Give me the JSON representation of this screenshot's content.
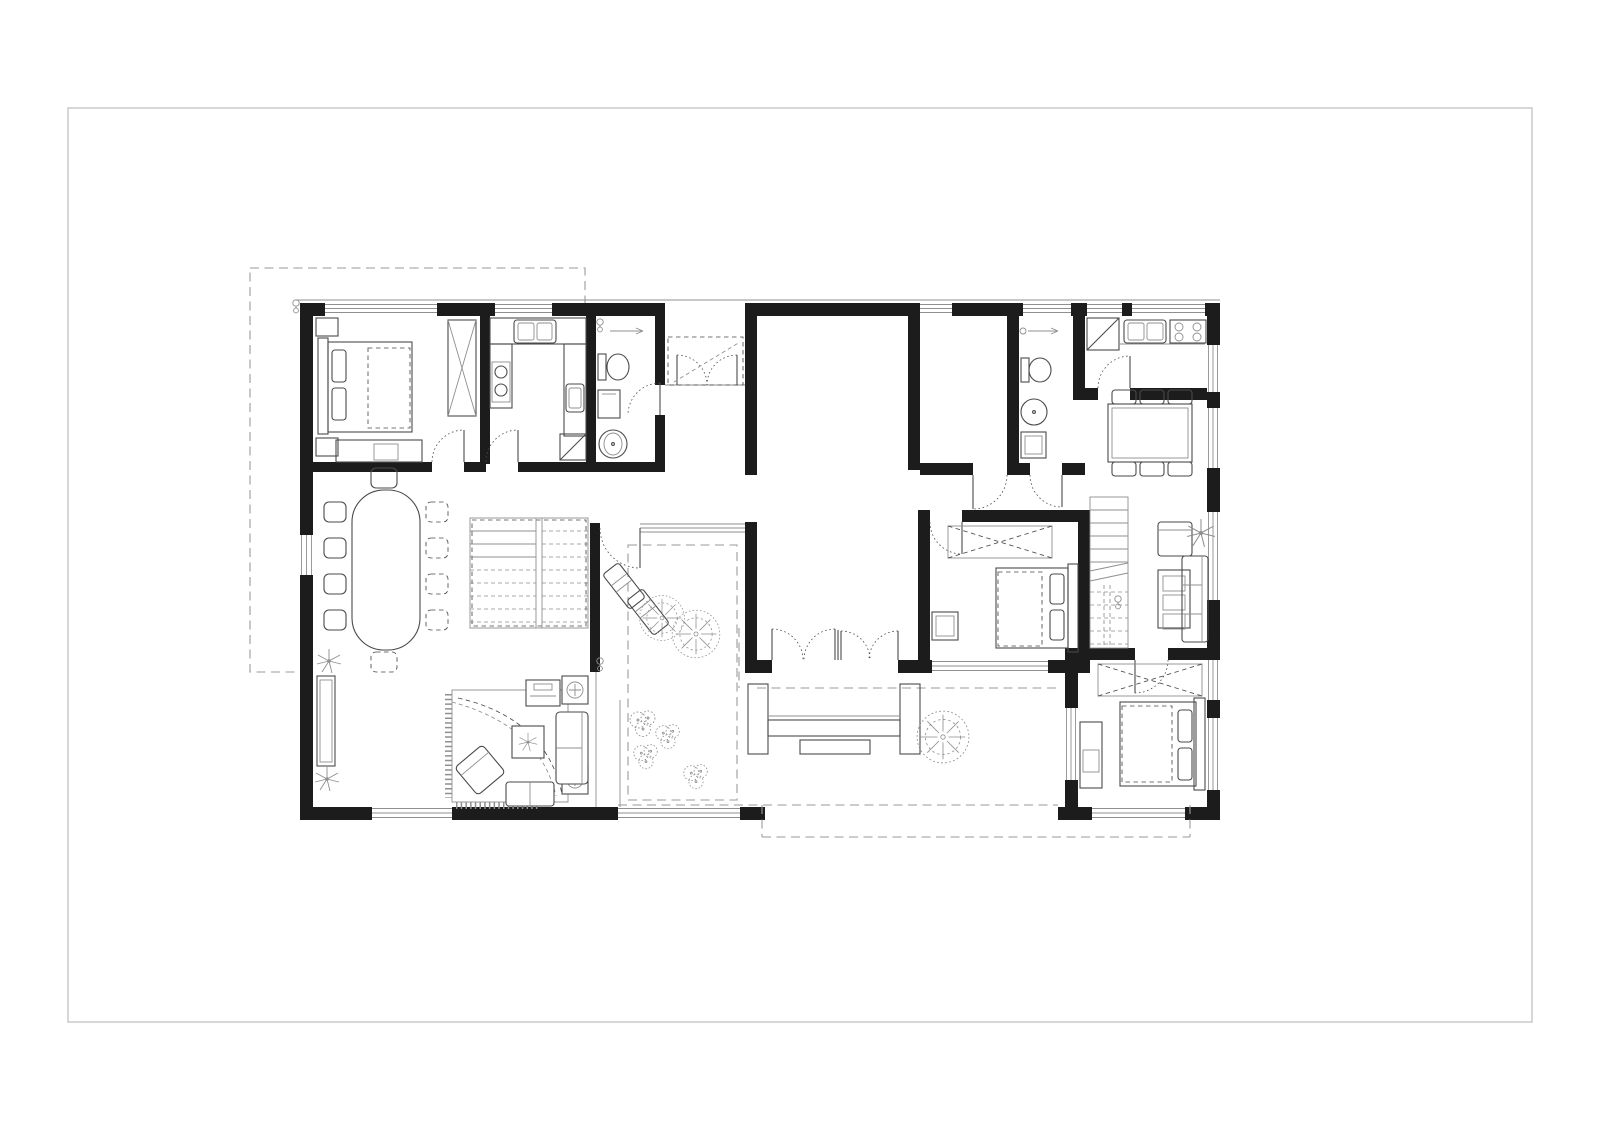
{
  "document": {
    "kind": "architectural floor plan sheet",
    "visible_text": [],
    "sheet": {
      "border": true
    }
  },
  "colors": {
    "paper": "#ffffff",
    "wall": "#1c1c1c",
    "line": "#4a4a4a",
    "lightline": "#8f8f8f",
    "dash": "#9a9a9a",
    "sheetBorder": "#c6c6c6"
  },
  "icons": {
    "tree-icon": "scribbled plan-view tree canopy",
    "shrub-icon": "cluster of small plan shrubs",
    "palm-plant-icon": "potted plant star symbol",
    "electrical-symbol-icon": "small wall-mounted fixture symbol",
    "door-swing-icon": "dotted quarter-circle door swing",
    "window-icon": "triple-line glazing in wall opening",
    "wardrobe-icon": "dashed crossed rectangle",
    "stair-icon": "stepped flight with break line"
  },
  "plan": {
    "outline": "rectangular villa with recessed north entry porch, inner courtyard and south terrace; dashed site/garage outline at upper left",
    "rooms": [
      {
        "id": "bedroom-1",
        "furniture": [
          "double-bed",
          "nightstands",
          "wardrobe",
          "desk"
        ]
      },
      {
        "id": "prep-kitchen",
        "furniture": [
          "double-sink",
          "cooktop-2-burner",
          "side-sink",
          "corner-cabinet"
        ]
      },
      {
        "id": "bathroom-1",
        "furniture": [
          "shower-point",
          "toilet",
          "cabinet",
          "round-basin"
        ]
      },
      {
        "id": "entry-porch",
        "furniture": [
          "double-entry-doors",
          "dashed-canopy"
        ]
      },
      {
        "id": "central-hall",
        "furniture": [
          "double-doors-to-terrace"
        ]
      },
      {
        "id": "bathroom-2",
        "furniture": [
          "shower-point",
          "toilet",
          "round-basin",
          "washer"
        ]
      },
      {
        "id": "main-kitchen",
        "furniture": [
          "corner-cabinet",
          "double-sink",
          "cooktop-4-burner"
        ]
      },
      {
        "id": "kitchen-dining",
        "furniture": [
          "table-for-6"
        ]
      },
      {
        "id": "family-room",
        "furniture": [
          "staircase",
          "armchair",
          "plant",
          "coffee-table",
          "sofa-3-seat"
        ]
      },
      {
        "id": "bedroom-2",
        "furniture": [
          "wardrobe",
          "double-bed",
          "desk"
        ]
      },
      {
        "id": "bedroom-3",
        "furniture": [
          "wardrobe",
          "double-bed",
          "desk"
        ]
      },
      {
        "id": "great-room",
        "furniture": [
          "dining-table-10-chairs",
          "sideboard",
          "palm-plants",
          "staircase",
          "fringed-rug",
          "tv-console",
          "speakers",
          "sofa",
          "bench",
          "rotated-armchair",
          "coffee-table-with-plant"
        ]
      },
      {
        "id": "inner-courtyard",
        "furniture": [
          "two-trees",
          "two-sun-loungers",
          "shrub-clusters"
        ]
      },
      {
        "id": "south-terrace",
        "furniture": [
          "built-in-bench",
          "side-tables",
          "low-table",
          "tree"
        ]
      }
    ]
  }
}
